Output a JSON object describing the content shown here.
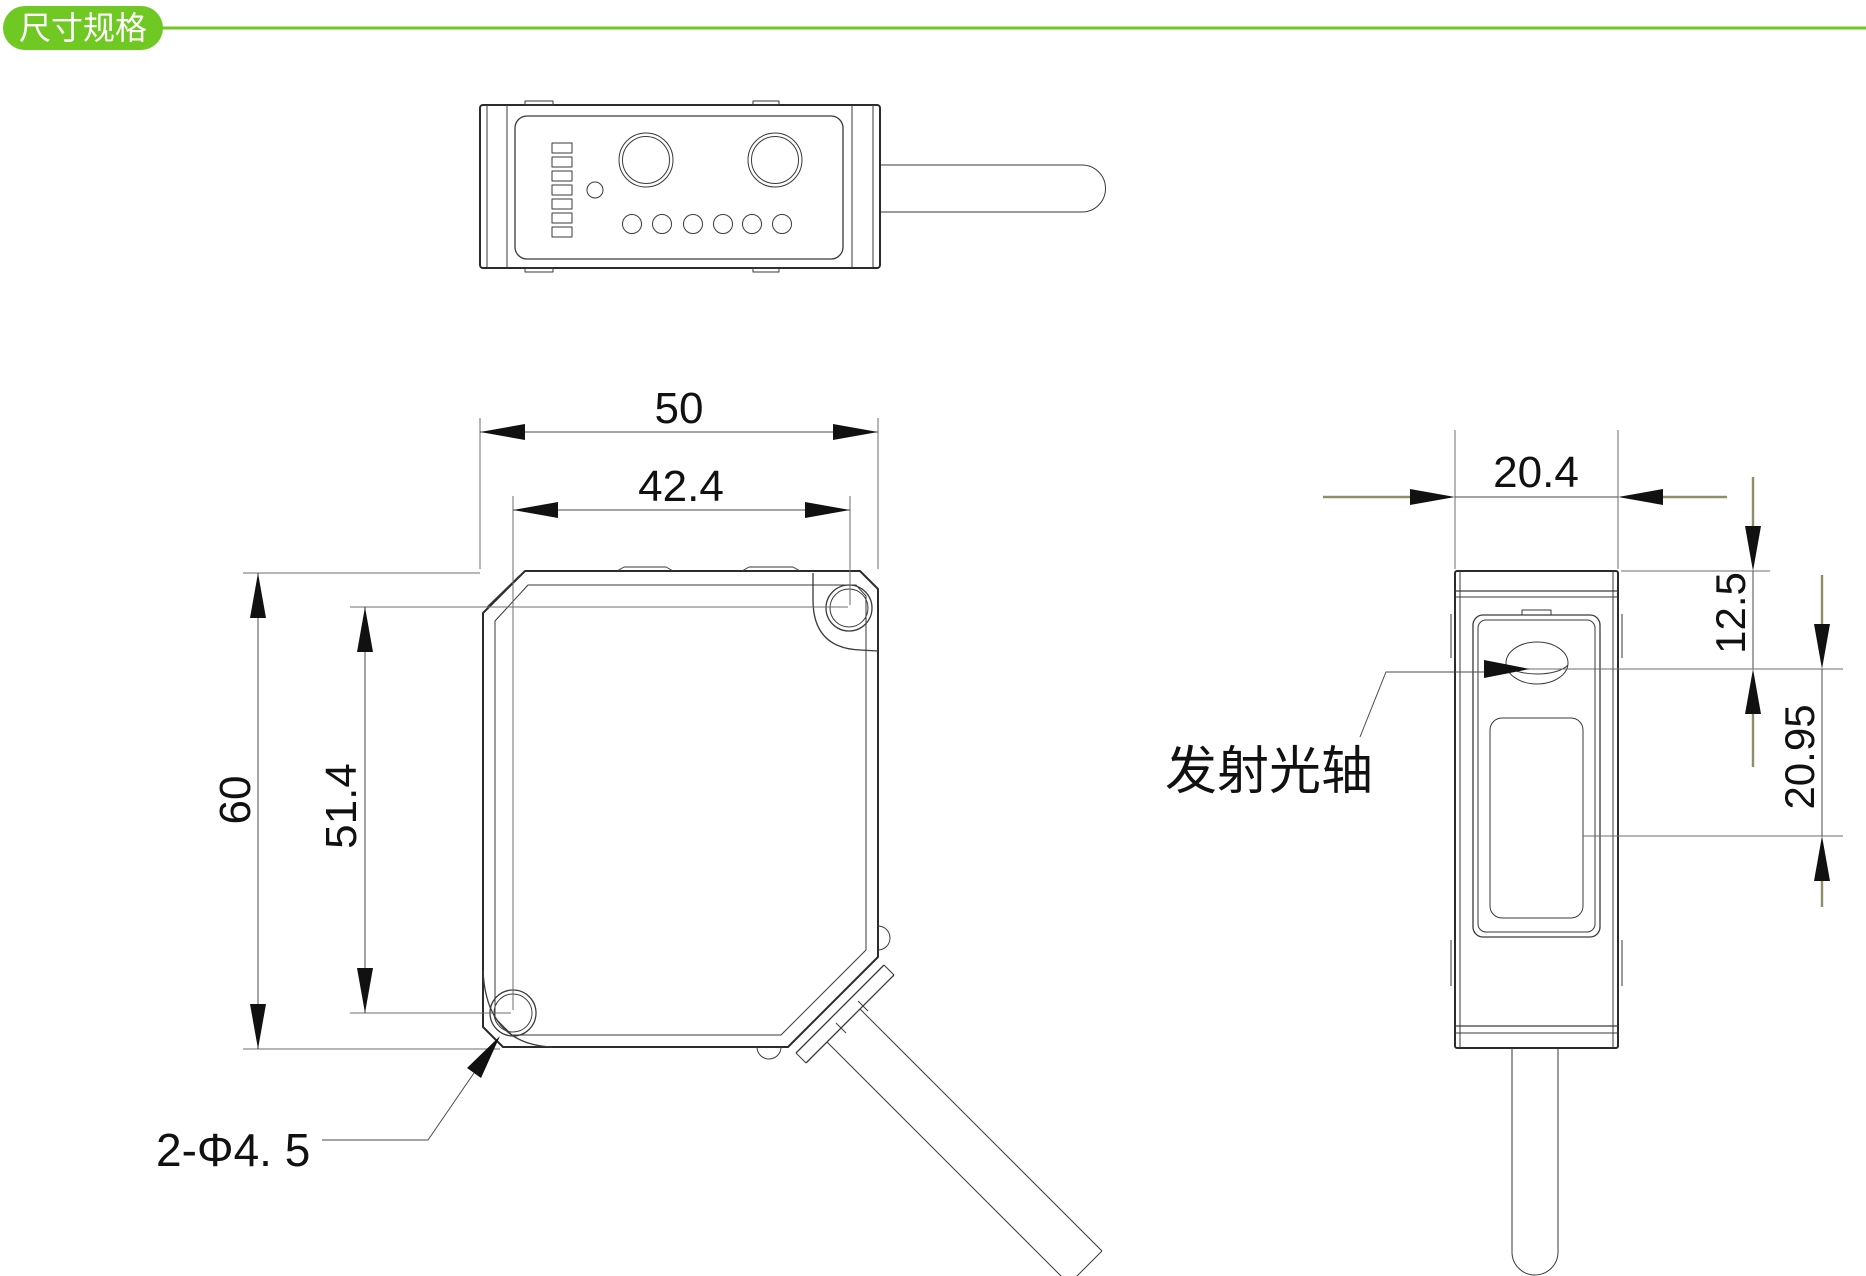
{
  "badge": {
    "label": "尺寸规格"
  },
  "front_view": {
    "dim_outer_width": "50",
    "dim_hole_spacing_x": "42.4",
    "dim_outer_height": "60",
    "dim_hole_spacing_y": "51.4",
    "mounting_holes_label": "2-Φ4. 5"
  },
  "side_view": {
    "dim_depth": "20.4",
    "dim_axis_from_top": "12.5",
    "dim_axis_to_window": "20.95",
    "emitter_axis_label": "发射光轴"
  },
  "colors": {
    "accent": "#70c922",
    "outline": "#2b2b2b",
    "dim_tail": "#8f8f66",
    "text": "#111111"
  }
}
